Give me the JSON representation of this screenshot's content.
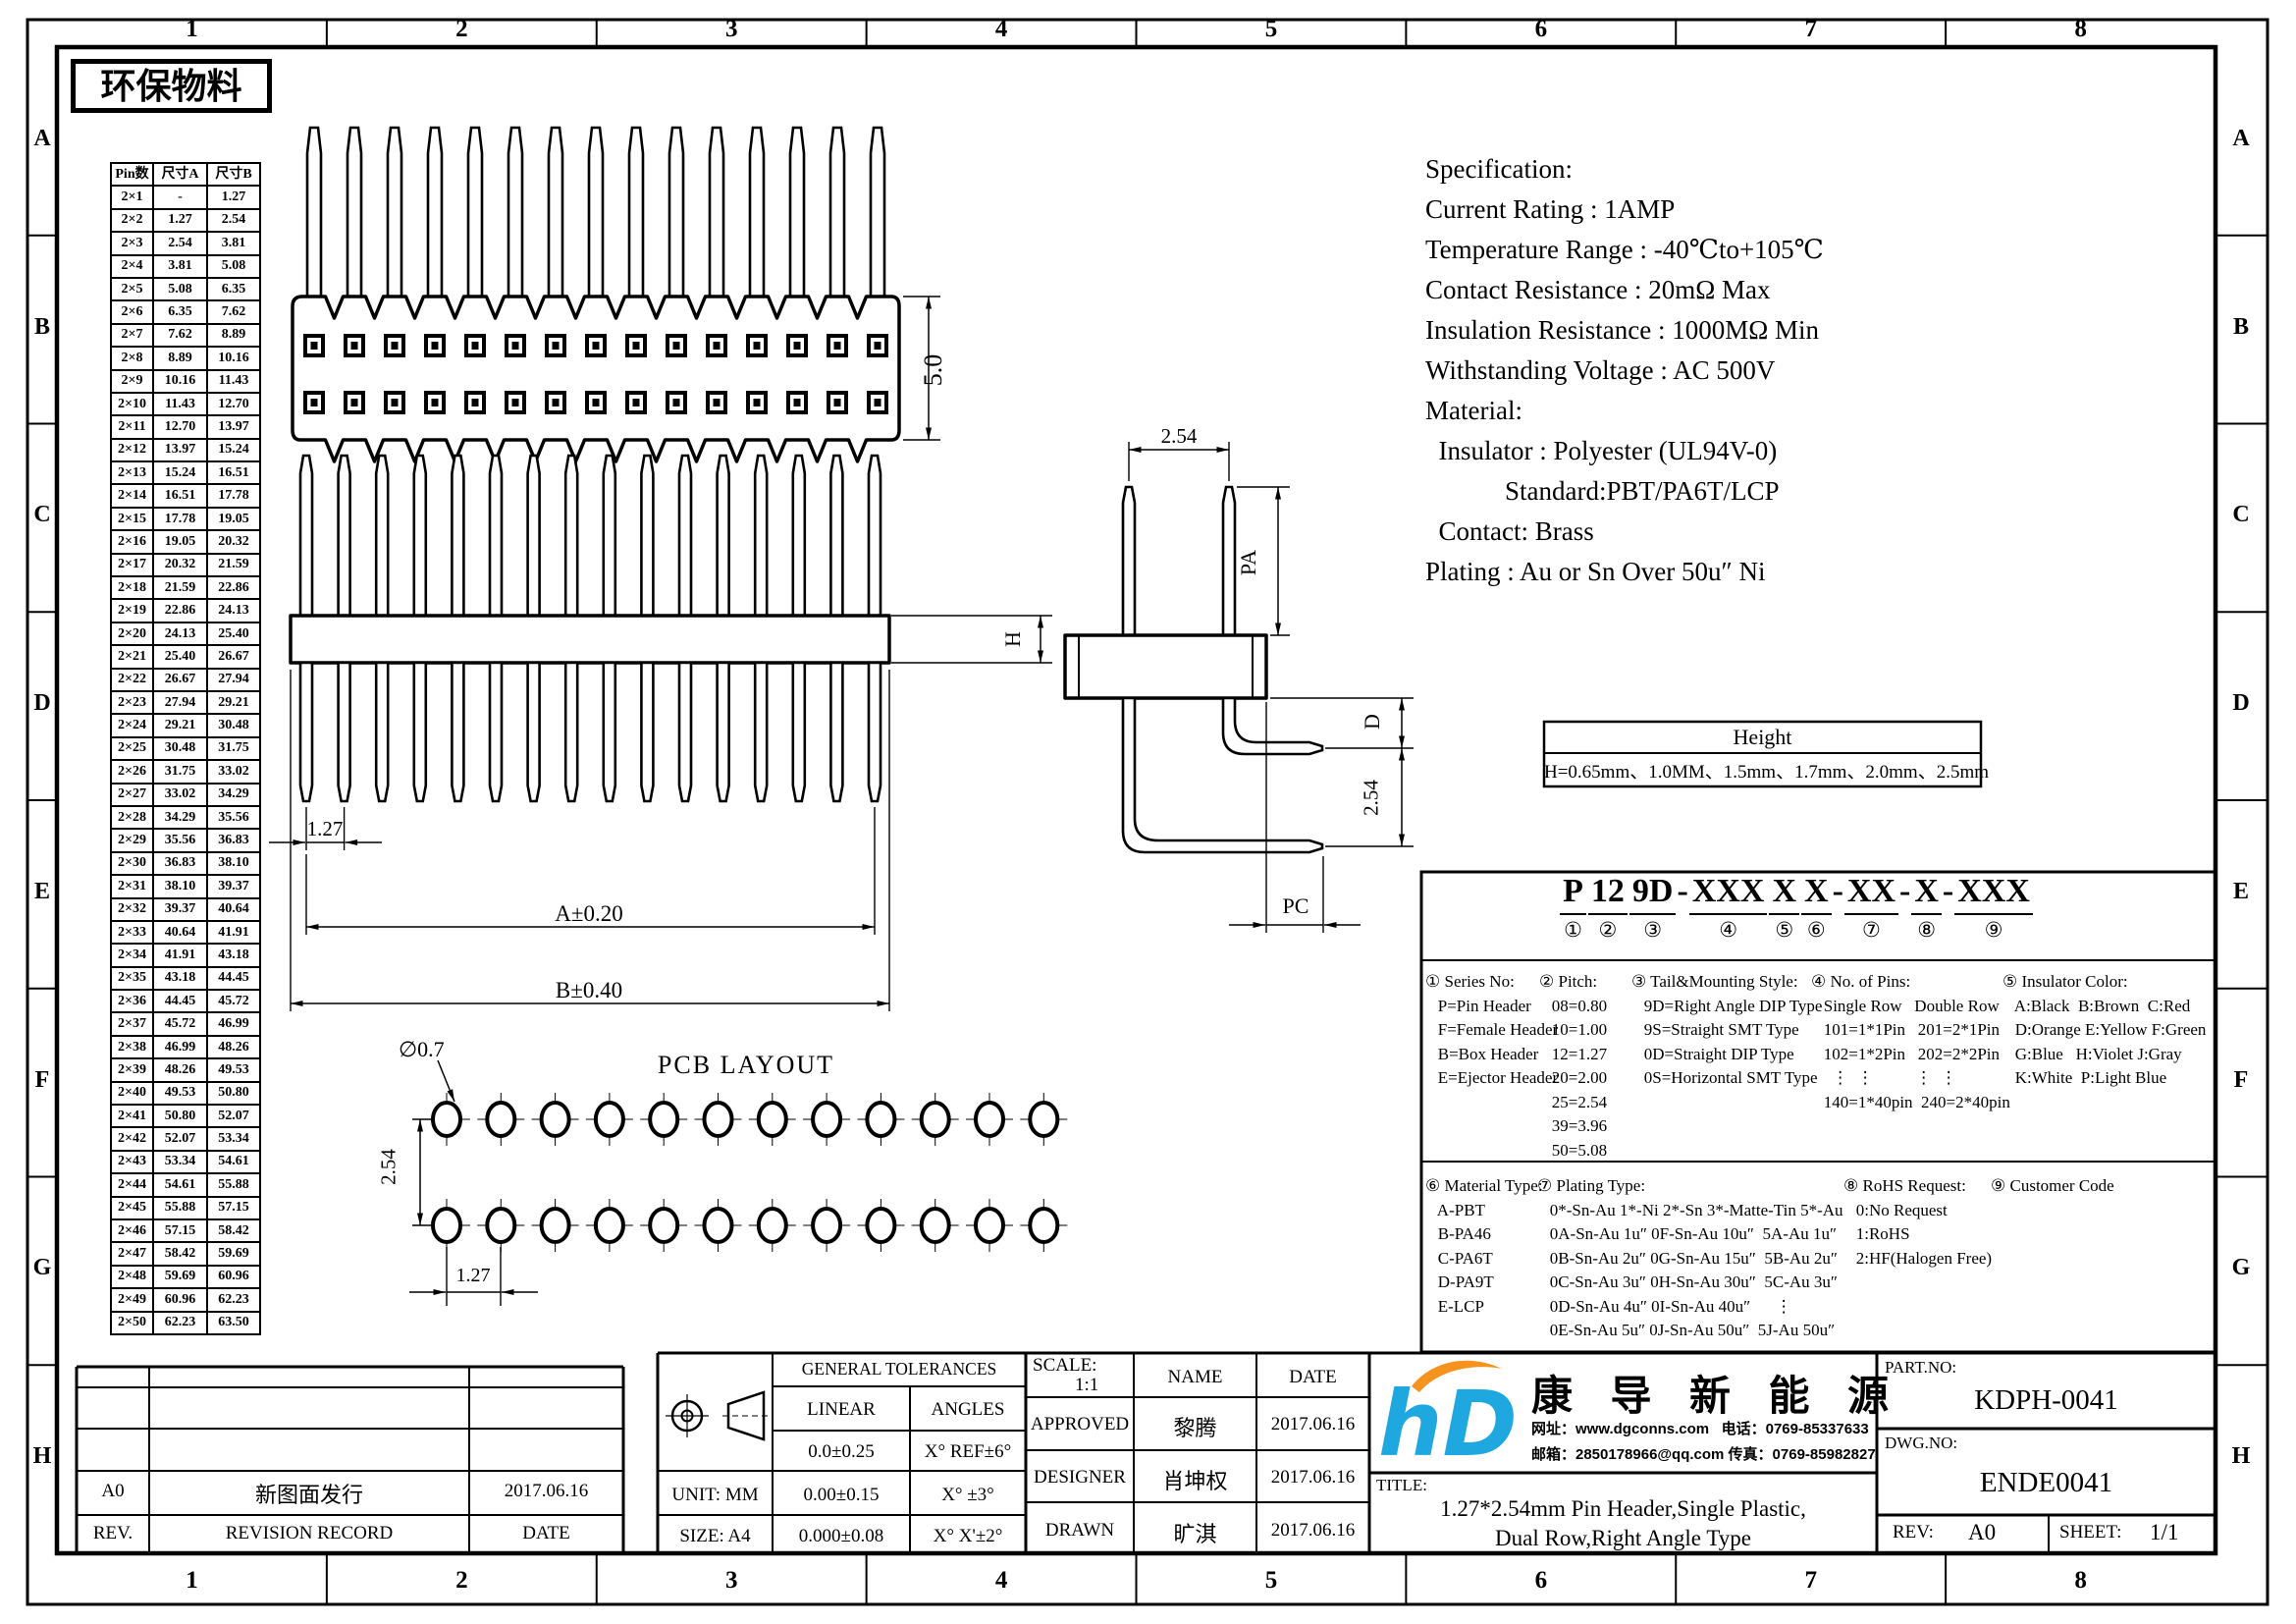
{
  "stamp": "环保物料",
  "grid": {
    "cols": [
      "1",
      "2",
      "3",
      "4",
      "5",
      "6",
      "7",
      "8"
    ],
    "rows": [
      "A",
      "B",
      "C",
      "D",
      "E",
      "F",
      "G",
      "H"
    ]
  },
  "pin_table": {
    "headers": [
      "Pin数",
      "尺寸A",
      "尺寸B"
    ],
    "rows": [
      [
        "2×1",
        "-",
        "1.27"
      ],
      [
        "2×2",
        "1.27",
        "2.54"
      ],
      [
        "2×3",
        "2.54",
        "3.81"
      ],
      [
        "2×4",
        "3.81",
        "5.08"
      ],
      [
        "2×5",
        "5.08",
        "6.35"
      ],
      [
        "2×6",
        "6.35",
        "7.62"
      ],
      [
        "2×7",
        "7.62",
        "8.89"
      ],
      [
        "2×8",
        "8.89",
        "10.16"
      ],
      [
        "2×9",
        "10.16",
        "11.43"
      ],
      [
        "2×10",
        "11.43",
        "12.70"
      ],
      [
        "2×11",
        "12.70",
        "13.97"
      ],
      [
        "2×12",
        "13.97",
        "15.24"
      ],
      [
        "2×13",
        "15.24",
        "16.51"
      ],
      [
        "2×14",
        "16.51",
        "17.78"
      ],
      [
        "2×15",
        "17.78",
        "19.05"
      ],
      [
        "2×16",
        "19.05",
        "20.32"
      ],
      [
        "2×17",
        "20.32",
        "21.59"
      ],
      [
        "2×18",
        "21.59",
        "22.86"
      ],
      [
        "2×19",
        "22.86",
        "24.13"
      ],
      [
        "2×20",
        "24.13",
        "25.40"
      ],
      [
        "2×21",
        "25.40",
        "26.67"
      ],
      [
        "2×22",
        "26.67",
        "27.94"
      ],
      [
        "2×23",
        "27.94",
        "29.21"
      ],
      [
        "2×24",
        "29.21",
        "30.48"
      ],
      [
        "2×25",
        "30.48",
        "31.75"
      ],
      [
        "2×26",
        "31.75",
        "33.02"
      ],
      [
        "2×27",
        "33.02",
        "34.29"
      ],
      [
        "2×28",
        "34.29",
        "35.56"
      ],
      [
        "2×29",
        "35.56",
        "36.83"
      ],
      [
        "2×30",
        "36.83",
        "38.10"
      ],
      [
        "2×31",
        "38.10",
        "39.37"
      ],
      [
        "2×32",
        "39.37",
        "40.64"
      ],
      [
        "2×33",
        "40.64",
        "41.91"
      ],
      [
        "2×34",
        "41.91",
        "43.18"
      ],
      [
        "2×35",
        "43.18",
        "44.45"
      ],
      [
        "2×36",
        "44.45",
        "45.72"
      ],
      [
        "2×37",
        "45.72",
        "46.99"
      ],
      [
        "2×38",
        "46.99",
        "48.26"
      ],
      [
        "2×39",
        "48.26",
        "49.53"
      ],
      [
        "2×40",
        "49.53",
        "50.80"
      ],
      [
        "2×41",
        "50.80",
        "52.07"
      ],
      [
        "2×42",
        "52.07",
        "53.34"
      ],
      [
        "2×43",
        "53.34",
        "54.61"
      ],
      [
        "2×44",
        "54.61",
        "55.88"
      ],
      [
        "2×45",
        "55.88",
        "57.15"
      ],
      [
        "2×46",
        "57.15",
        "58.42"
      ],
      [
        "2×47",
        "58.42",
        "59.69"
      ],
      [
        "2×48",
        "59.69",
        "60.96"
      ],
      [
        "2×49",
        "60.96",
        "62.23"
      ],
      [
        "2×50",
        "62.23",
        "63.50"
      ]
    ]
  },
  "views": {
    "front_height": "5.0",
    "pitch": "1.27",
    "dim_a": "A±0.20",
    "dim_b": "B±0.40",
    "body_h": "H",
    "top_pitch": "2.54",
    "pin_above": "PA",
    "tail_d": "D",
    "row_space": "2.54",
    "tail_pc": "PC"
  },
  "pcb": {
    "title": "PCB LAYOUT",
    "hole_dia": "∅0.7",
    "row_pitch": "2.54",
    "pitch": "1.27"
  },
  "spec": "Specification:\nCurrent Rating : 1AMP\nTemperature Range : -40℃to+105℃\nContact Resistance : 20mΩ Max\nInsulation Resistance : 1000MΩ Min\nWithstanding Voltage : AC 500V\nMaterial:\n  Insulator : Polyester (UL94V-0)\n            Standard:PBT/PA6T/LCP\n  Contact: Brass\nPlating : Au or Sn Over 50u″ Ni",
  "height_table": {
    "title": "Height",
    "value": "H=0.65mm、1.0MM、1.5mm、1.7mm、2.0mm、2.5mm"
  },
  "part_number": {
    "segments": [
      {
        "t": "P",
        "n": "①"
      },
      {
        "t": "12",
        "n": "②"
      },
      {
        "t": "9D",
        "n": "③"
      },
      {
        "t": "XXX",
        "n": "④"
      },
      {
        "t": "X",
        "n": "⑤"
      },
      {
        "t": "X",
        "n": "⑥"
      },
      {
        "t": "XX",
        "n": "⑦"
      },
      {
        "t": "X",
        "n": "⑧"
      },
      {
        "t": "XXX",
        "n": "⑨"
      }
    ],
    "seps": [
      " ",
      " ",
      "-",
      " ",
      " ",
      "-",
      "-",
      "-",
      ""
    ]
  },
  "ordering": {
    "s1": "① Series No:\n   P=Pin Header\n   F=Female Header\n   B=Box Header\n   E=Ejector Header",
    "s2": "② Pitch:\n   08=0.80\n   10=1.00\n   12=1.27\n   20=2.00\n   25=2.54\n   39=3.96\n   50=5.08",
    "s3": "③ Tail&Mounting Style:\n   9D=Right Angle DIP Type\n   9S=Straight SMT Type\n   0D=Straight DIP Type\n   0S=Horizontal SMT Type",
    "s4": "④ No. of Pins:\n   Single Row   Double Row\n   101=1*1Pin   201=2*1Pin\n   102=1*2Pin   202=2*2Pin\n     ⋮  ⋮          ⋮  ⋮\n   140=1*40pin  240=2*40pin",
    "s5": "⑤ Insulator Color:\n   A:Black  B:Brown  C:Red\n   D:Orange E:Yellow F:Green\n   G:Blue   H:Violet J:Gray\n   K:White  P:Light Blue",
    "s6": "⑥ Material Type:\n   A-PBT\n   B-PA46\n   C-PA6T\n   D-PA9T\n   E-LCP",
    "s7": "⑦ Plating Type:\n   0*-Sn-Au 1*-Ni 2*-Sn 3*-Matte-Tin 5*-Au\n   0A-Sn-Au 1u″ 0F-Sn-Au 10u″  5A-Au 1u″\n   0B-Sn-Au 2u″ 0G-Sn-Au 15u″  5B-Au 2u″\n   0C-Sn-Au 3u″ 0H-Sn-Au 30u″  5C-Au 3u″\n   0D-Sn-Au 4u″ 0I-Sn-Au 40u″      ⋮\n   0E-Sn-Au 5u″ 0J-Sn-Au 50u″  5J-Au 50u″",
    "s8": "⑧ RoHS Request:\n   0:No Request\n   1:RoHS\n   2:HF(Halogen Free)",
    "s9": "⑨ Customer Code"
  },
  "title_block": {
    "general_tolerances": {
      "title": "GENERAL TOLERANCES",
      "col1": "LINEAR",
      "col2": "ANGLES",
      "rows": [
        [
          "0.0±0.25",
          "X° REF±6°"
        ],
        [
          "0.00±0.15",
          "X° ±3°"
        ],
        [
          "0.000±0.08",
          "X° X'±2°"
        ]
      ]
    },
    "unit": "UNIT: MM",
    "size": "SIZE: A4",
    "scale_label": "SCALE:",
    "scale": "1:1",
    "name": "NAME",
    "date": "DATE",
    "approved": "APPROVED",
    "approved_name": "黎腾",
    "approved_date": "2017.06.16",
    "designer": "DESIGNER",
    "designer_name": "肖坤权",
    "designer_date": "2017.06.16",
    "drawn": "DRAWN",
    "drawn_name": "旷淇",
    "drawn_date": "2017.06.16",
    "rev_value": "A0",
    "rev_desc": "新图面发行",
    "rev_date": "2017.06.16",
    "rev_label": "REV.",
    "record_label": "REVISION RECORD",
    "date_label": "DATE",
    "brand": {
      "mark": "hD",
      "name": "康 导 新 能 源",
      "line1": "网址：www.dgconns.com   电话：0769-85337633",
      "line2": "邮箱：2850178966@qq.com 传真：0769-85982827",
      "blue": "#1FA7E0",
      "orange": "#F6921E"
    },
    "title_label": "TITLE:",
    "title1": "1.27*2.54mm Pin Header,Single Plastic,",
    "title2": "Dual Row,Right Angle Type",
    "part_label": "PART.NO:",
    "part_no": "KDPH-0041",
    "dwg_label": "DWG.NO:",
    "dwg_no": "ENDE0041",
    "rev2_label": "REV:",
    "rev2": "A0",
    "sheet_label": "SHEET:",
    "sheet": "1/1"
  }
}
